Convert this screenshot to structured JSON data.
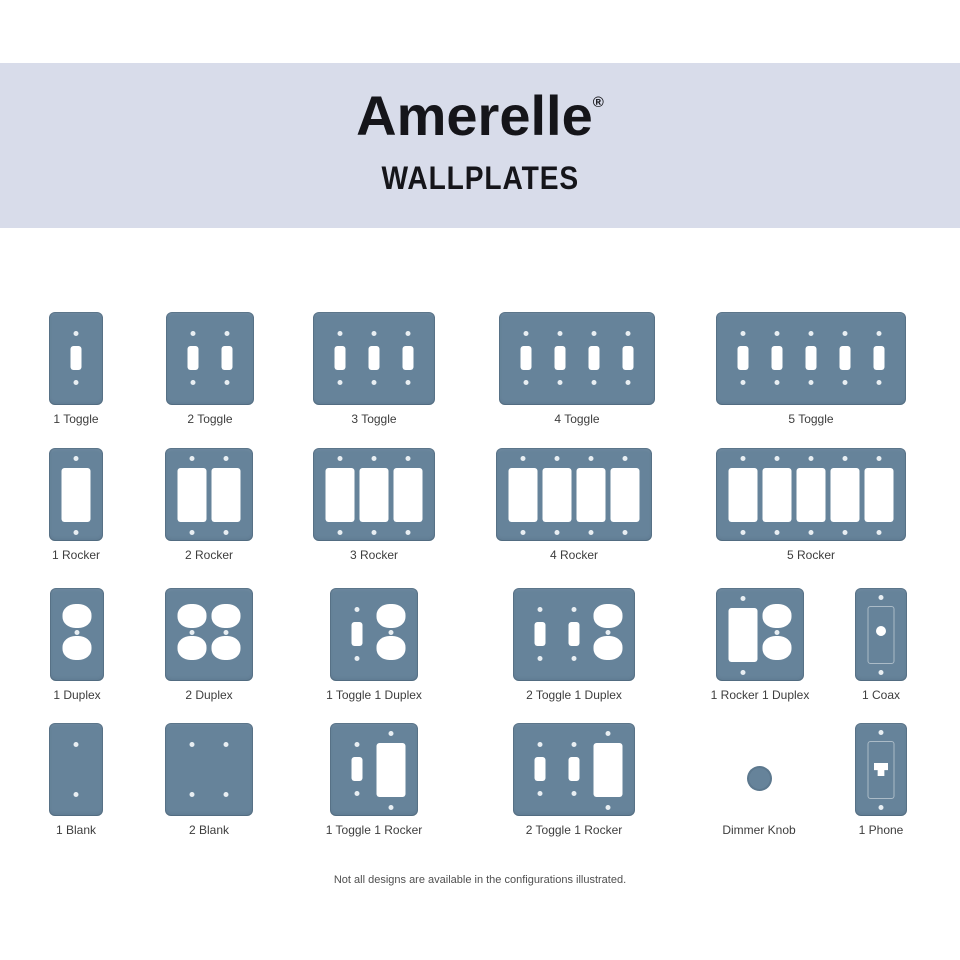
{
  "header": {
    "brand": "Amerelle",
    "registered_mark": "®",
    "subtitle": "WALLPLATES"
  },
  "footer": {
    "disclaimer": "Not all designs are available in the configurations illustrated."
  },
  "colors": {
    "band": "#d8dcea",
    "title": "#15151a",
    "plate": "#66839a",
    "cutout": "#ffffff",
    "screw": "#e8eef2",
    "label": "#3d3d3d",
    "footer": "#4f4f4f"
  },
  "catalog": {
    "rows": [
      {
        "top": 312,
        "items": [
          {
            "label": "1 Toggle",
            "cx": 76,
            "kind": "plate",
            "slots": [
              "toggle"
            ]
          },
          {
            "label": "2 Toggle",
            "cx": 210,
            "kind": "plate",
            "slots": [
              "toggle",
              "toggle"
            ]
          },
          {
            "label": "3 Toggle",
            "cx": 374,
            "kind": "plate",
            "slots": [
              "toggle",
              "toggle",
              "toggle"
            ]
          },
          {
            "label": "4 Toggle",
            "cx": 577,
            "kind": "plate",
            "slots": [
              "toggle",
              "toggle",
              "toggle",
              "toggle"
            ]
          },
          {
            "label": "5 Toggle",
            "cx": 811,
            "kind": "plate",
            "slots": [
              "toggle",
              "toggle",
              "toggle",
              "toggle",
              "toggle"
            ]
          }
        ]
      },
      {
        "top": 448,
        "items": [
          {
            "label": "1 Rocker",
            "cx": 76,
            "kind": "plate",
            "slots": [
              "rocker"
            ]
          },
          {
            "label": "2 Rocker",
            "cx": 209,
            "kind": "plate",
            "slots": [
              "rocker",
              "rocker"
            ]
          },
          {
            "label": "3 Rocker",
            "cx": 374,
            "kind": "plate",
            "slots": [
              "rocker",
              "rocker",
              "rocker"
            ]
          },
          {
            "label": "4 Rocker",
            "cx": 574,
            "kind": "plate",
            "slots": [
              "rocker",
              "rocker",
              "rocker",
              "rocker"
            ]
          },
          {
            "label": "5 Rocker",
            "cx": 811,
            "kind": "plate",
            "slots": [
              "rocker",
              "rocker",
              "rocker",
              "rocker",
              "rocker"
            ]
          }
        ]
      },
      {
        "top": 588,
        "items": [
          {
            "label": "1 Duplex",
            "cx": 77,
            "kind": "plate",
            "slots": [
              "duplex"
            ]
          },
          {
            "label": "2 Duplex",
            "cx": 209,
            "kind": "plate",
            "slots": [
              "duplex",
              "duplex"
            ]
          },
          {
            "label": "1 Toggle 1 Duplex",
            "cx": 374,
            "kind": "plate",
            "slots": [
              "toggle",
              "duplex"
            ]
          },
          {
            "label": "2 Toggle 1 Duplex",
            "cx": 574,
            "kind": "plate",
            "slots": [
              "toggle",
              "toggle",
              "duplex"
            ]
          },
          {
            "label": "1 Rocker 1 Duplex",
            "cx": 760,
            "kind": "plate",
            "slots": [
              "rocker",
              "duplex"
            ]
          },
          {
            "label": "1 Coax",
            "cx": 881,
            "kind": "plate",
            "slots": [
              "coax"
            ]
          }
        ]
      },
      {
        "top": 723,
        "items": [
          {
            "label": "1 Blank",
            "cx": 76,
            "kind": "plate",
            "slots": [
              "blank"
            ]
          },
          {
            "label": "2 Blank",
            "cx": 209,
            "kind": "plate",
            "slots": [
              "blank",
              "blank"
            ]
          },
          {
            "label": "1 Toggle 1 Rocker",
            "cx": 374,
            "kind": "plate",
            "slots": [
              "toggle",
              "rocker"
            ]
          },
          {
            "label": "2 Toggle 1 Rocker",
            "cx": 574,
            "kind": "plate",
            "slots": [
              "toggle",
              "toggle",
              "rocker"
            ]
          },
          {
            "label": "Dimmer Knob",
            "cx": 759,
            "kind": "knob"
          },
          {
            "label": "1 Phone",
            "cx": 881,
            "kind": "plate",
            "slots": [
              "phone"
            ]
          }
        ]
      }
    ]
  }
}
